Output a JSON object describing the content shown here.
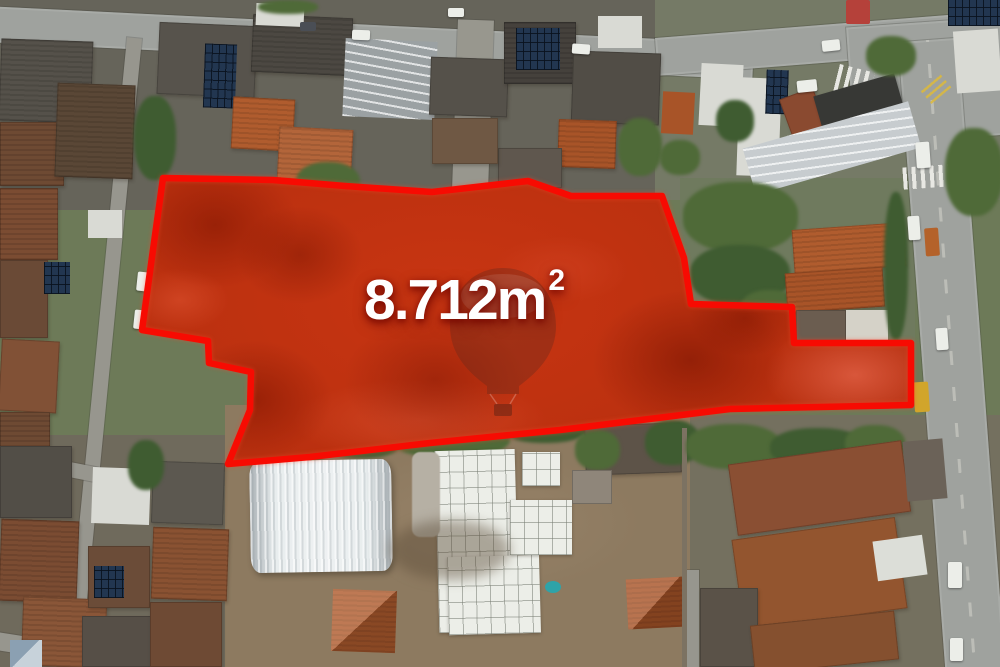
{
  "land_overlay": {
    "area_value": "8.712m",
    "area_superscript": "2",
    "area_label_full": "8.712m²",
    "fill_color": "#c13211",
    "border_color": "#f70b02",
    "watermark_icon": "hot-air-balloon-icon",
    "polygon_points": "163,178 273,180 345,186 432,192 528,181 571,196 662,196 684,258 691,304 792,307 794,343 911,343 911,405 730,409 560,430 430,443 310,457 228,464 250,410 251,372 209,363 208,341 142,330 152,257"
  }
}
